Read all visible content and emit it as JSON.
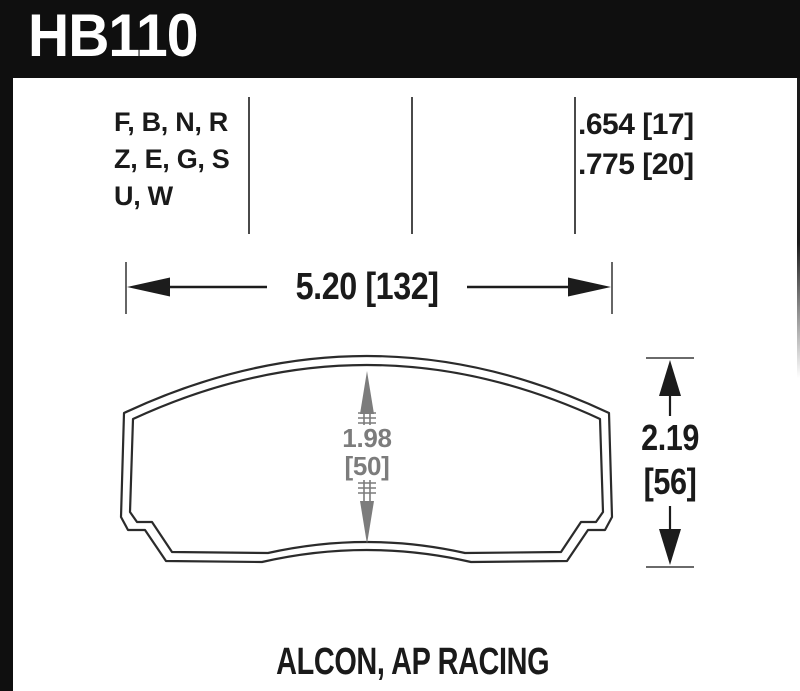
{
  "header": {
    "part_number": "HB110"
  },
  "spec_table": {
    "compound_lines": [
      "F, B, N, R",
      "Z, E, G, S",
      "U, W"
    ],
    "thickness_lines": [
      ".654 [17]",
      ".775 [20]"
    ]
  },
  "dimensions": {
    "width_label": "5.20 [132]",
    "height": {
      "line1": "2.19",
      "line2": "[56]"
    },
    "center_height": {
      "line1": "1.98",
      "line2": "[50]"
    }
  },
  "footer": {
    "applications": "ALCON, AP RACING"
  },
  "colors": {
    "frame_black": "#0f0f0f",
    "ink": "#1a1a1a",
    "dimension_gray": "#7c7c7c",
    "divider_gray": "#4a4a4a"
  }
}
